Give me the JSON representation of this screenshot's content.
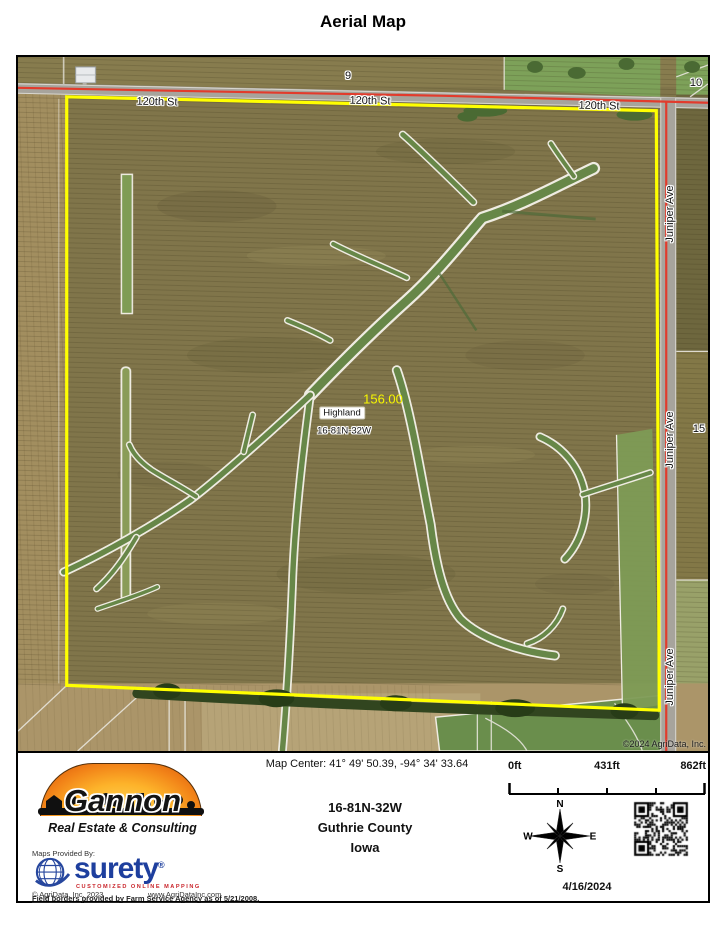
{
  "title": "Aerial Map",
  "map": {
    "street_top": "120th St",
    "street_right": "Juniper Ave",
    "section_9": "9",
    "section_10": "10",
    "section_15": "15",
    "parcel_acres": "156.00",
    "parcel_name": "Highland",
    "parcel_trs": "16-81N-32W",
    "copyright": "©2024 AgriData, Inc.",
    "boundary_color": "#ffff00",
    "road_line_color": "#e23b2c",
    "acres_label_color": "#f6f600"
  },
  "footer": {
    "map_center": "Map Center: 41° 49' 50.39,  -94° 34' 33.64",
    "location": {
      "trs": "16-81N-32W",
      "county": "Guthrie County",
      "state": "Iowa"
    },
    "scale_bar": {
      "start": "0ft",
      "mid": "431ft",
      "end": "862ft"
    },
    "compass": {
      "n": "N",
      "e": "E",
      "s": "S",
      "w": "W"
    },
    "date": "4/16/2024",
    "logo": {
      "name": "Gannon",
      "tagline": "Real Estate & Consulting"
    },
    "provided_by": "Maps Provided By:",
    "surety": {
      "name": "surety",
      "reg": "®",
      "tagline": "CUSTOMIZED ONLINE MAPPING"
    },
    "agridata_copyright": "© AgriData, Inc. 2023",
    "website": "www.AgriDataInc.com",
    "disclaimer": "Field borders provided by Farm Service Agency as of 5/21/2008."
  }
}
